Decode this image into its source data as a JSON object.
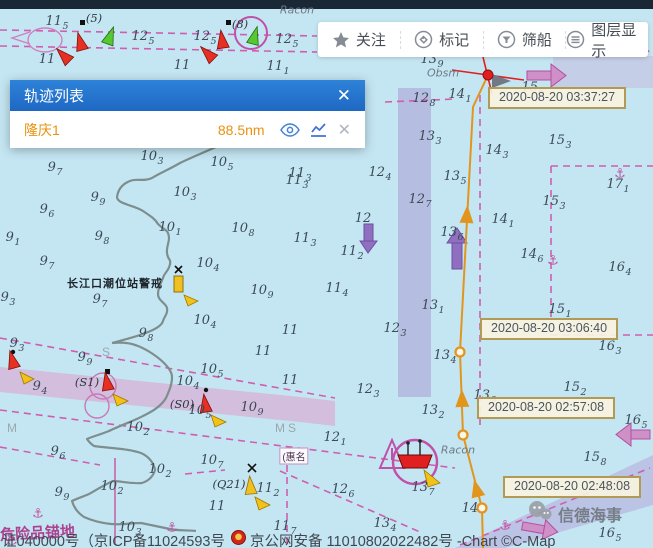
{
  "ui": {
    "toolbar": [
      {
        "label": "关注",
        "icon": "star-icon"
      },
      {
        "label": "标记",
        "icon": "tag-icon"
      },
      {
        "label": "筛船",
        "icon": "filter-icon"
      },
      {
        "label": "图层显示",
        "icon": "layers-icon"
      }
    ],
    "panel": {
      "title": "轨迹列表",
      "close_glyph": "✕",
      "rows": [
        {
          "name": "隆庆1",
          "distance": "88.5nm",
          "close_glyph": "✕"
        }
      ]
    }
  },
  "map": {
    "timestamps": [
      {
        "text": "2020-08-20 03:37:27",
        "x": 488,
        "y": 87
      },
      {
        "text": "2020-08-20 03:06:40",
        "x": 480,
        "y": 318
      },
      {
        "text": "2020-08-20 02:57:08",
        "x": 477,
        "y": 397
      },
      {
        "text": "2020-08-20 02:48:08",
        "x": 503,
        "y": 476
      }
    ],
    "track": {
      "color": "#e2951d",
      "points": [
        [
          483,
          548
        ],
        [
          482,
          508
        ],
        [
          463,
          435
        ],
        [
          460,
          352
        ],
        [
          473,
          107
        ],
        [
          488,
          75
        ]
      ],
      "waypoints": [
        [
          482,
          508
        ],
        [
          463,
          435
        ],
        [
          460,
          352
        ]
      ],
      "arrows": [
        [
          476,
          487,
          -14
        ],
        [
          462,
          397,
          -2
        ],
        [
          467,
          213,
          3
        ]
      ],
      "ship_dot": [
        488,
        75
      ]
    },
    "soundings": [
      [
        57,
        22,
        "11",
        "5"
      ],
      [
        143,
        37,
        "12",
        "5"
      ],
      [
        205,
        37,
        "12",
        "5"
      ],
      [
        287,
        40,
        "12",
        "5"
      ],
      [
        47,
        60,
        "11",
        ""
      ],
      [
        182,
        66,
        "11",
        ""
      ],
      [
        278,
        67,
        "11",
        "1"
      ],
      [
        432,
        60,
        "13",
        "9"
      ],
      [
        424,
        99,
        "12",
        "8"
      ],
      [
        460,
        95,
        "14",
        "1"
      ],
      [
        533,
        88,
        "15",
        "6"
      ],
      [
        430,
        137,
        "13",
        "3"
      ],
      [
        560,
        141,
        "15",
        "3"
      ],
      [
        497,
        151,
        "14",
        "3"
      ],
      [
        618,
        185,
        "17",
        "1"
      ],
      [
        554,
        202,
        "15",
        "3"
      ],
      [
        455,
        177,
        "13",
        "5"
      ],
      [
        420,
        200,
        "12",
        "7"
      ],
      [
        380,
        173,
        "12",
        "4"
      ],
      [
        300,
        174,
        "11",
        "3"
      ],
      [
        222,
        163,
        "10",
        "5"
      ],
      [
        185,
        193,
        "10",
        "3"
      ],
      [
        152,
        157,
        "10",
        "3"
      ],
      [
        170,
        228,
        "10",
        "1"
      ],
      [
        297,
        181,
        "11",
        "3"
      ],
      [
        243,
        229,
        "10",
        "8"
      ],
      [
        305,
        239,
        "11",
        "3"
      ],
      [
        55,
        168,
        "9",
        "7"
      ],
      [
        47,
        210,
        "9",
        "6"
      ],
      [
        13,
        238,
        "9",
        "1"
      ],
      [
        98,
        198,
        "9",
        "9"
      ],
      [
        102,
        237,
        "9",
        "8"
      ],
      [
        47,
        262,
        "9",
        "7"
      ],
      [
        8,
        298,
        "9",
        "3"
      ],
      [
        100,
        300,
        "9",
        "7"
      ],
      [
        208,
        264,
        "10",
        "4"
      ],
      [
        262,
        291,
        "10",
        "9"
      ],
      [
        337,
        289,
        "11",
        "4"
      ],
      [
        205,
        321,
        "10",
        "4"
      ],
      [
        290,
        331,
        "11",
        ""
      ],
      [
        146,
        334,
        "9",
        "8"
      ],
      [
        352,
        252,
        "11",
        "2"
      ],
      [
        363,
        219,
        "12",
        ""
      ],
      [
        452,
        233,
        "13",
        "6"
      ],
      [
        503,
        220,
        "14",
        "1"
      ],
      [
        532,
        255,
        "14",
        "6"
      ],
      [
        620,
        268,
        "16",
        "4"
      ],
      [
        433,
        306,
        "13",
        "1"
      ],
      [
        395,
        329,
        "12",
        "3"
      ],
      [
        445,
        356,
        "13",
        "4"
      ],
      [
        368,
        390,
        "12",
        "3"
      ],
      [
        433,
        411,
        "13",
        "2"
      ],
      [
        485,
        396,
        "13",
        "9"
      ],
      [
        560,
        310,
        "15",
        "1"
      ],
      [
        610,
        347,
        "16",
        "3"
      ],
      [
        575,
        388,
        "15",
        "2"
      ],
      [
        636,
        421,
        "16",
        "5"
      ],
      [
        595,
        458,
        "15",
        "8"
      ],
      [
        17,
        344,
        "9",
        "3"
      ],
      [
        85,
        358,
        "9",
        "9"
      ],
      [
        40,
        387,
        "9",
        "4"
      ],
      [
        212,
        370,
        "10",
        "5"
      ],
      [
        188,
        382,
        "10",
        "4"
      ],
      [
        263,
        352,
        "11",
        ""
      ],
      [
        290,
        381,
        "11",
        ""
      ],
      [
        252,
        408,
        "10",
        "9"
      ],
      [
        138,
        428,
        "10",
        "2"
      ],
      [
        200,
        411,
        "10",
        "5"
      ],
      [
        335,
        438,
        "12",
        "1"
      ],
      [
        343,
        490,
        "12",
        "6"
      ],
      [
        423,
        488,
        "13",
        "7"
      ],
      [
        285,
        527,
        "11",
        "7"
      ],
      [
        385,
        524,
        "13",
        "4"
      ],
      [
        58,
        452,
        "9",
        "6"
      ],
      [
        62,
        493,
        "9",
        "9"
      ],
      [
        112,
        487,
        "10",
        "2"
      ],
      [
        160,
        470,
        "10",
        "2"
      ],
      [
        130,
        528,
        "10",
        "3"
      ],
      [
        212,
        461,
        "10",
        "7"
      ],
      [
        217,
        507,
        "11",
        ""
      ],
      [
        268,
        489,
        "11",
        "2"
      ],
      [
        610,
        534,
        "16",
        "5"
      ],
      [
        470,
        509,
        "14",
        ""
      ]
    ],
    "labels": [
      [
        94,
        18,
        "(5)",
        "dk"
      ],
      [
        240,
        24,
        "(8)",
        "dk"
      ],
      [
        297,
        10,
        "Racon",
        "gi"
      ],
      [
        458,
        450,
        "Racon",
        "gi"
      ],
      [
        443,
        73,
        "Obsm",
        "gi"
      ],
      [
        115,
        283,
        "长江口潮位站警戒",
        "st"
      ],
      [
        87,
        382,
        "(S1)",
        "dk"
      ],
      [
        182,
        404,
        "(S0)",
        "dk"
      ],
      [
        229,
        484,
        "(Q21)",
        "dk"
      ],
      [
        294,
        456,
        "(惠名",
        "lbx"
      ],
      [
        12,
        428,
        "M",
        "gr"
      ],
      [
        280,
        428,
        "M",
        "gr"
      ],
      [
        292,
        428,
        "S",
        "gr"
      ],
      [
        106,
        352,
        "S",
        "gr"
      ]
    ],
    "anchors": [
      [
        38,
        514
      ],
      [
        620,
        174
      ],
      [
        12,
        541
      ],
      [
        553,
        261
      ],
      [
        172,
        528
      ],
      [
        505,
        526
      ]
    ]
  },
  "footer": {
    "license_left": "证040000号（京ICP备11024593号",
    "security_right": "京公网安备 11010802022482号  -Chart ©C-Map",
    "overprint": "危险品锚地"
  },
  "watermark": {
    "text": "信德海事"
  }
}
